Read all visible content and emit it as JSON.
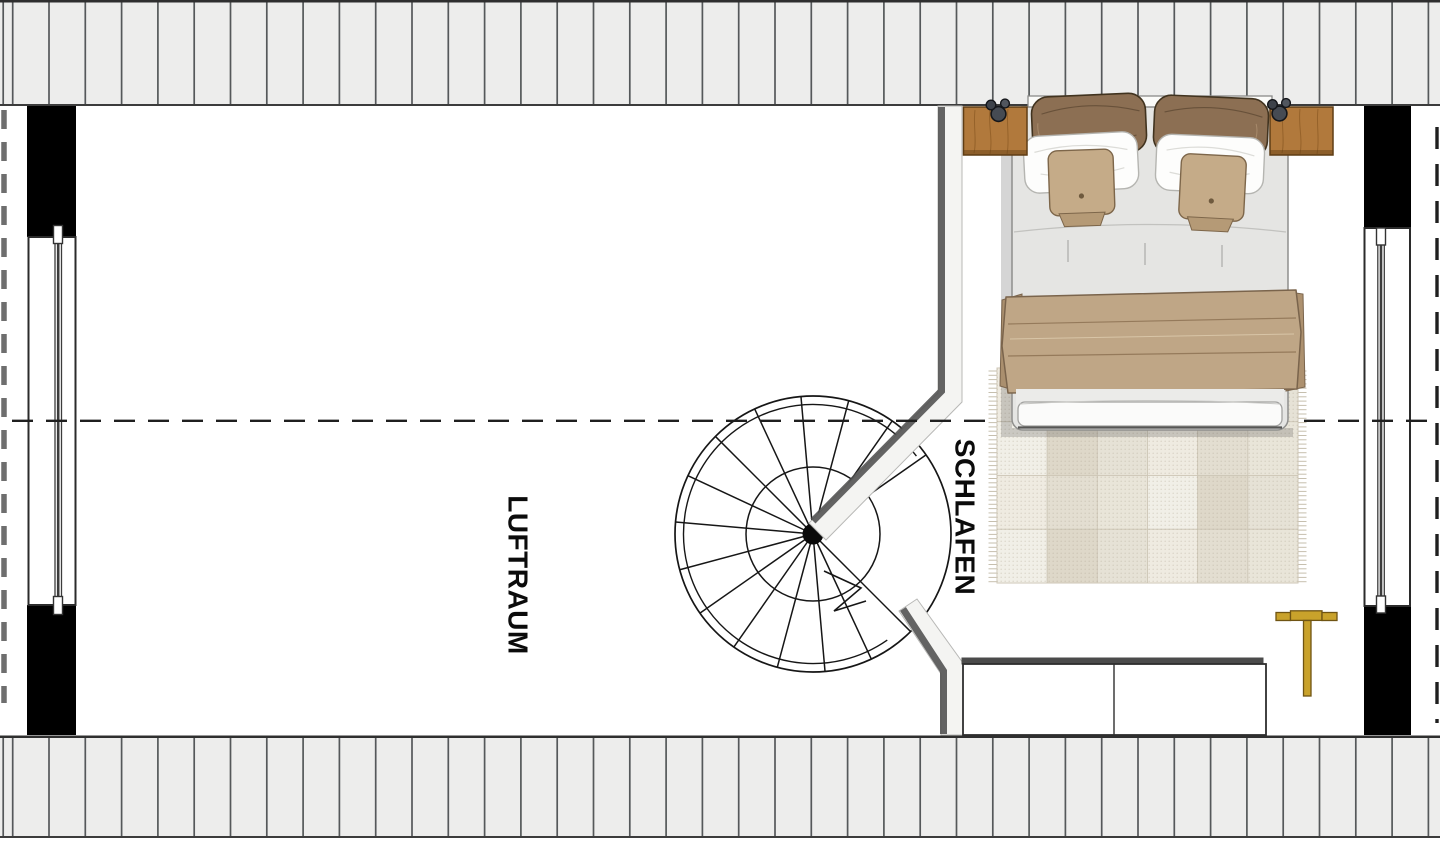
{
  "labels": {
    "airspace": "LUFTRAUM",
    "bedroom": "SCHLAFEN"
  },
  "colors": {
    "background": "#ffffff",
    "roof_hatch_fill": "#ededec",
    "roof_hatch_line": "#55585a",
    "wall_black": "#000000",
    "wall_band_fill": "#f4f4f2",
    "wall_band_shadow": "#4e4e4e",
    "dashed_dark": "#1f1f1f",
    "dashed_gray": "#6e6e6e",
    "stair_line": "#161616",
    "window_frame": "#2b2b2b",
    "wood_brown": "#b1793c",
    "wood_brown_dark": "#5f3d14",
    "gold": "#c9a22b",
    "gold_dark": "#6f5413",
    "pillow_brown": "#8c6f53",
    "cushion_tan": "#c5ab88",
    "blanket_tan": "#bfa686",
    "duvet_gray": "#e5e5e3",
    "rug_base": "#eae6dc"
  },
  "roof_hatch": {
    "start_x": 12.7,
    "spacing": 36.3,
    "extra_line_x": 3.2,
    "top": {
      "y0": 0,
      "y1": 106
    },
    "bottom": {
      "y0": 735.5,
      "y1": 838
    }
  },
  "stair": {
    "cx": 813,
    "cy": 534,
    "r_outer": 138,
    "r_rail": 129.5,
    "r_inner": 67,
    "r_hub": 10.5,
    "tread_start_deg": 45,
    "tread_end_deg": 325,
    "tread_step_deg": 20,
    "rail_start_deg": 55,
    "rail_end_deg": 323,
    "break_points": "824,571 861,588 834,611 866,601"
  },
  "ridge_line": {
    "y": 420.8,
    "x1": 12,
    "y_dash": "21 13",
    "x2": 1437
  },
  "eaves_left": {
    "x": 4,
    "y1": 110,
    "y2": 703
  },
  "eaves_right": {
    "x": 1437,
    "y1": 127,
    "y2": 723
  },
  "rug": {
    "x": 997,
    "y": 368,
    "w": 301,
    "h": 215,
    "cols": 6,
    "rows": 4,
    "palette": [
      "#efebe1",
      "#e2ddcf",
      "#e9e4d8",
      "#f2efe8",
      "#ddd6c6",
      "#e6e1d5"
    ]
  }
}
